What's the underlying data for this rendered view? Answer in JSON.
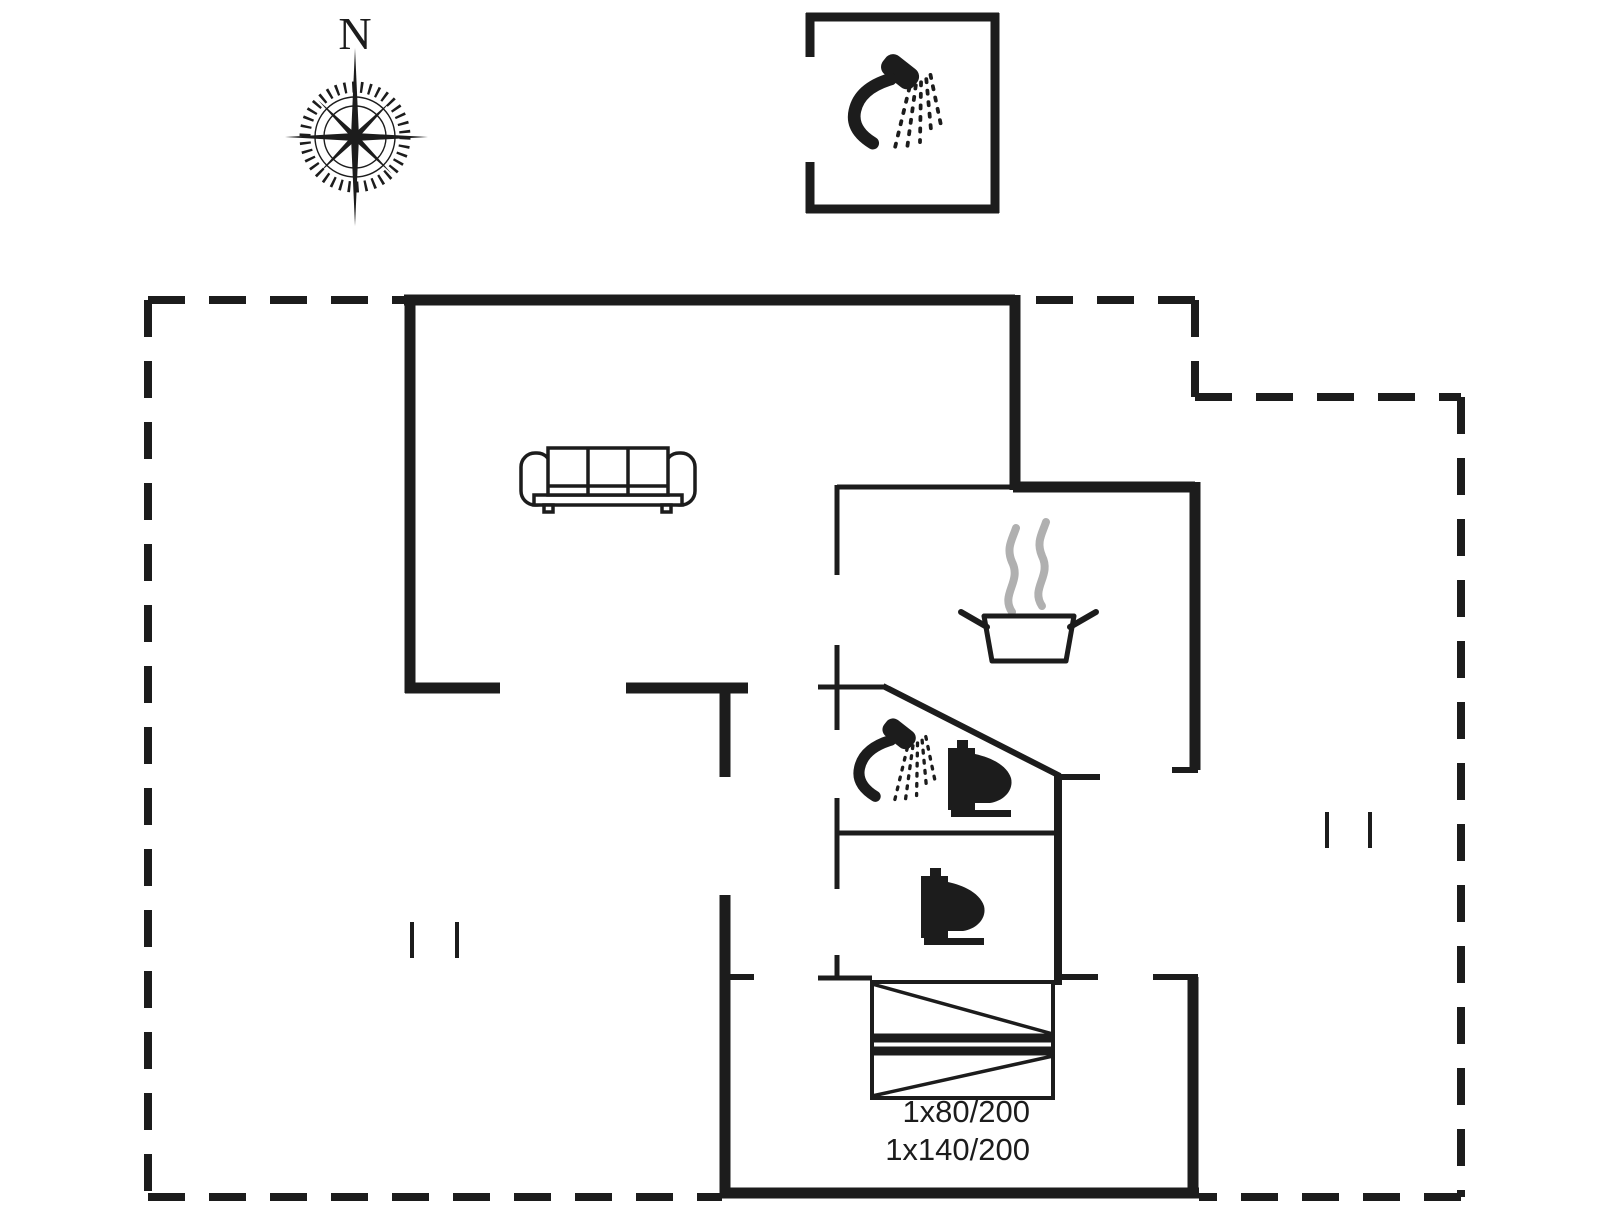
{
  "colors": {
    "ink": "#1c1c1c",
    "steam": "#b0b0b0",
    "bg": "#ffffff"
  },
  "compass": {
    "label": "N"
  },
  "bed_annotation": {
    "line1": "1x80/200",
    "line2": "1x140/200"
  },
  "icons": {
    "compass": "compass-rose-icon",
    "outbuilding_shower": "shower-icon",
    "sofa": "sofa-icon",
    "kitchen_pot": "cooking-pot-icon",
    "kitchen_steam": "steam-icon",
    "bathroom_shower": "shower-icon",
    "bathroom_toilet": "toilet-icon",
    "wc_toilet": "toilet-icon",
    "bedroom_bunk_bed": "bunk-bed-icon"
  }
}
